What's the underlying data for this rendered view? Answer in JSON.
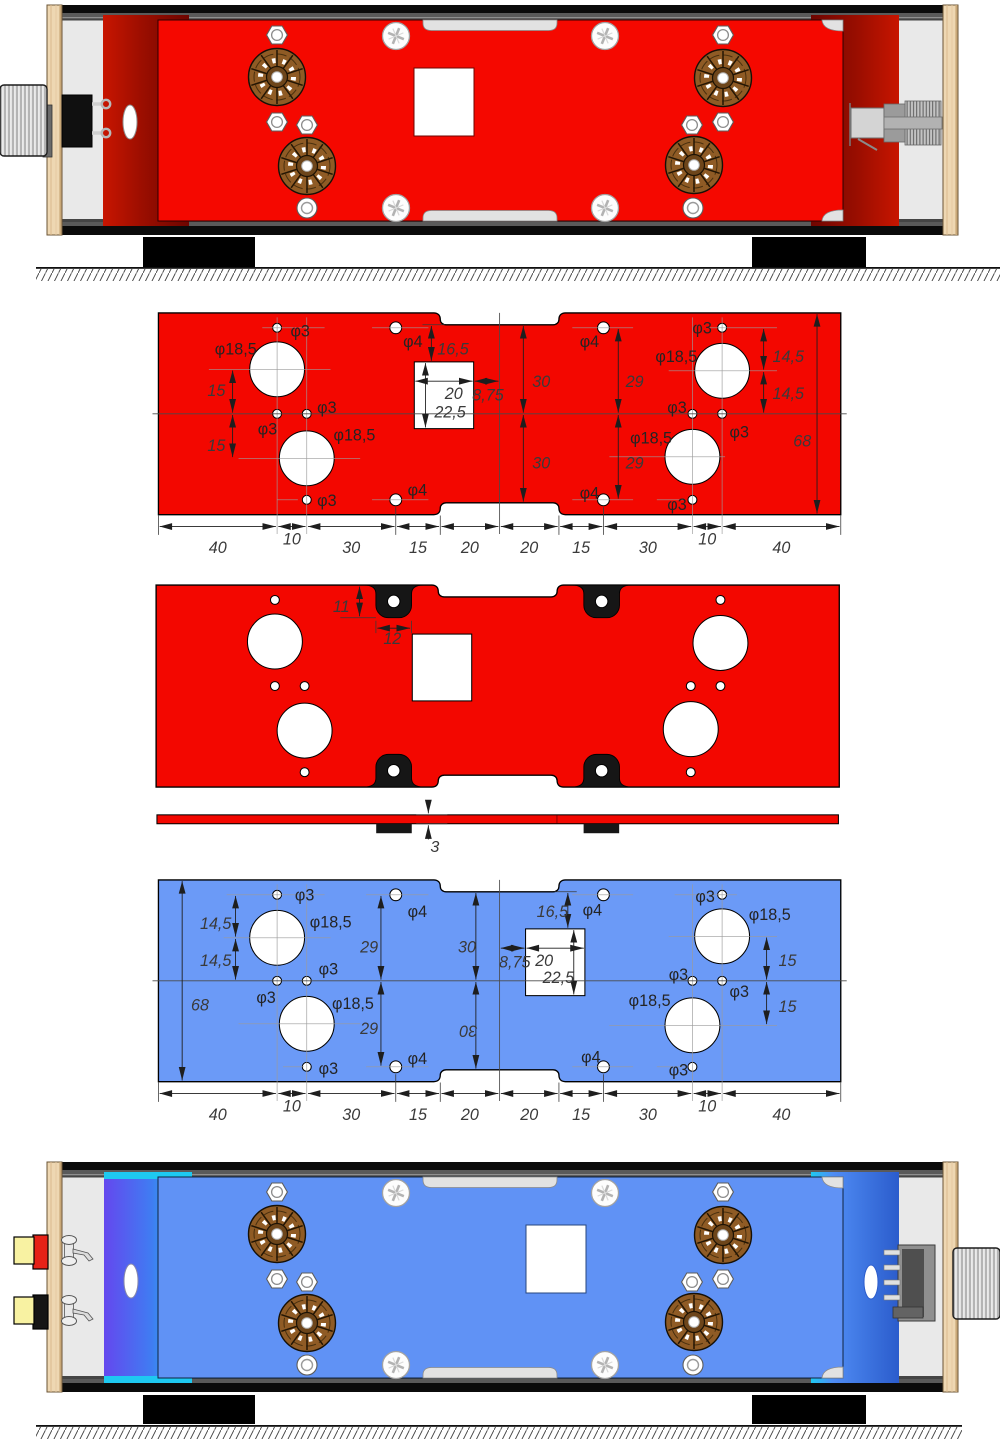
{
  "palette": {
    "red_plate": "#f30700",
    "blue_plate": "#6b9af7",
    "rendered_red_plate": "#f50800",
    "rendered_blue_plate": "#6092f5",
    "dark_red_panel": "#6e0500",
    "blue_panel_purple": "#6448ee",
    "cyan_edge": "#1ec9f1",
    "wood": "#eed7b2",
    "interior_gray": "#e9e9e9",
    "socket_brown": "#8f5b25",
    "rca_yellow": "#f8f2a2",
    "rca_red_ring": "#e62217",
    "dimension_text": "#3a3a3a"
  },
  "red_plate": {
    "labels": [
      {
        "t": "φ3",
        "x": 44.5,
        "y": 8
      },
      {
        "t": "φ18,5",
        "x": 19,
        "y": 14
      },
      {
        "t": "15",
        "x": 16.5,
        "y": 28,
        "it": 1
      },
      {
        "t": "15",
        "x": 16.5,
        "y": 46.5,
        "it": 1
      },
      {
        "t": "φ3",
        "x": 33.5,
        "y": 41
      },
      {
        "t": "φ3",
        "x": 53.5,
        "y": 33.8
      },
      {
        "t": "φ18,5",
        "x": 59,
        "y": 43
      },
      {
        "t": "φ3",
        "x": 53.5,
        "y": 65
      },
      {
        "t": "φ4",
        "x": 82.5,
        "y": 11.5
      },
      {
        "t": "φ4",
        "x": 84,
        "y": 61.5
      },
      {
        "t": "16,5",
        "x": 94,
        "y": 14,
        "it": 1
      },
      {
        "t": "20",
        "x": 96.5,
        "y": 29,
        "it": 1
      },
      {
        "t": "8,75",
        "x": 105.8,
        "y": 29.5,
        "it": 1
      },
      {
        "t": "22,5",
        "x": 93,
        "y": 35.3,
        "it": 1
      },
      {
        "t": "30",
        "x": 126,
        "y": 25,
        "it": 1
      },
      {
        "t": "30",
        "x": 126,
        "y": 52.5,
        "it": 1
      },
      {
        "t": "29",
        "x": 157.5,
        "y": 25,
        "it": 1
      },
      {
        "t": "29",
        "x": 157.5,
        "y": 52.5,
        "it": 1
      },
      {
        "t": "φ4",
        "x": 142,
        "y": 11.5
      },
      {
        "t": "φ4",
        "x": 142,
        "y": 62.5
      },
      {
        "t": "φ3",
        "x": 180,
        "y": 7
      },
      {
        "t": "φ18,5",
        "x": 167.5,
        "y": 16.5
      },
      {
        "t": "14,5",
        "x": 207,
        "y": 16.5,
        "it": 1
      },
      {
        "t": "14,5",
        "x": 207,
        "y": 29,
        "it": 1
      },
      {
        "t": "φ3",
        "x": 171.5,
        "y": 33.8
      },
      {
        "t": "φ3",
        "x": 192.5,
        "y": 42
      },
      {
        "t": "φ18,5",
        "x": 159,
        "y": 44
      },
      {
        "t": "68",
        "x": 214,
        "y": 45,
        "it": 1
      },
      {
        "t": "φ3",
        "x": 171.5,
        "y": 66.5
      },
      {
        "t": "40",
        "x": 20,
        "y": 81,
        "it": 1,
        "mid": 1
      },
      {
        "t": "10",
        "x": 45,
        "y": 78,
        "it": 1,
        "mid": 1
      },
      {
        "t": "30",
        "x": 65,
        "y": 81,
        "it": 1,
        "mid": 1
      },
      {
        "t": "15",
        "x": 87.5,
        "y": 81,
        "it": 1,
        "mid": 1
      },
      {
        "t": "20",
        "x": 105,
        "y": 81,
        "it": 1,
        "mid": 1
      },
      {
        "t": "20",
        "x": 125,
        "y": 81,
        "it": 1,
        "mid": 1
      },
      {
        "t": "15",
        "x": 142.5,
        "y": 81,
        "it": 1,
        "mid": 1
      },
      {
        "t": "30",
        "x": 165,
        "y": 81,
        "it": 1,
        "mid": 1
      },
      {
        "t": "10",
        "x": 185,
        "y": 78,
        "it": 1,
        "mid": 1
      },
      {
        "t": "40",
        "x": 210,
        "y": 81,
        "it": 1,
        "mid": 1
      }
    ]
  },
  "drill_plate": {
    "labels": [
      {
        "t": "11",
        "x": 59.5,
        "y": 9,
        "it": 1
      },
      {
        "t": "12",
        "x": 76.5,
        "y": 19.8,
        "it": 1
      }
    ]
  },
  "side_view": {
    "labels": [
      {
        "t": "3",
        "x": 92.3,
        "y": 12.6,
        "it": 1
      }
    ]
  },
  "blue_plate": {
    "labels": [
      {
        "t": "14,5",
        "x": 14,
        "y": 16.5,
        "it": 1
      },
      {
        "t": "14,5",
        "x": 14,
        "y": 29,
        "it": 1
      },
      {
        "t": "68",
        "x": 11,
        "y": 44,
        "it": 1
      },
      {
        "t": "φ3",
        "x": 46,
        "y": 7
      },
      {
        "t": "φ18,5",
        "x": 51,
        "y": 16
      },
      {
        "t": "φ3",
        "x": 54,
        "y": 31.8
      },
      {
        "t": "φ3",
        "x": 33,
        "y": 41.5
      },
      {
        "t": "φ18,5",
        "x": 58.5,
        "y": 43.5
      },
      {
        "t": "φ3",
        "x": 54,
        "y": 65.5
      },
      {
        "t": "29",
        "x": 68,
        "y": 24.5,
        "it": 1
      },
      {
        "t": "29",
        "x": 68,
        "y": 52,
        "it": 1
      },
      {
        "t": "φ4",
        "x": 84,
        "y": 12.5
      },
      {
        "t": "φ4",
        "x": 84,
        "y": 62
      },
      {
        "t": "30",
        "x": 101,
        "y": 24.5,
        "it": 1
      },
      {
        "t": "30",
        "x": 104.5,
        "y": 49,
        "it": 1,
        "mid": 1,
        "rot": 180
      },
      {
        "t": "16,5",
        "x": 127.5,
        "y": 12.5,
        "it": 1
      },
      {
        "t": "φ4",
        "x": 143,
        "y": 12
      },
      {
        "t": "φ4",
        "x": 142.5,
        "y": 61.5
      },
      {
        "t": "8,75",
        "x": 114.8,
        "y": 29.5,
        "it": 1
      },
      {
        "t": "20",
        "x": 127,
        "y": 29,
        "it": 1
      },
      {
        "t": "22,5",
        "x": 129.5,
        "y": 34.8,
        "it": 1
      },
      {
        "t": "φ3",
        "x": 172,
        "y": 33.8
      },
      {
        "t": "φ18,5",
        "x": 158.5,
        "y": 42.5
      },
      {
        "t": "φ3",
        "x": 181,
        "y": 7.5
      },
      {
        "t": "φ18,5",
        "x": 199,
        "y": 13.5
      },
      {
        "t": "φ3",
        "x": 192.5,
        "y": 39.5
      },
      {
        "t": "15",
        "x": 209,
        "y": 29,
        "it": 1
      },
      {
        "t": "15",
        "x": 209,
        "y": 44.5,
        "it": 1
      },
      {
        "t": "φ3",
        "x": 172,
        "y": 66
      },
      {
        "t": "40",
        "x": 20,
        "y": 81,
        "it": 1,
        "mid": 1
      },
      {
        "t": "10",
        "x": 45,
        "y": 78,
        "it": 1,
        "mid": 1
      },
      {
        "t": "30",
        "x": 65,
        "y": 81,
        "it": 1,
        "mid": 1
      },
      {
        "t": "15",
        "x": 87.5,
        "y": 81,
        "it": 1,
        "mid": 1
      },
      {
        "t": "20",
        "x": 105,
        "y": 81,
        "it": 1,
        "mid": 1
      },
      {
        "t": "20",
        "x": 125,
        "y": 81,
        "it": 1,
        "mid": 1
      },
      {
        "t": "15",
        "x": 142.5,
        "y": 81,
        "it": 1,
        "mid": 1
      },
      {
        "t": "30",
        "x": 165,
        "y": 81,
        "it": 1,
        "mid": 1
      },
      {
        "t": "10",
        "x": 185,
        "y": 78,
        "it": 1,
        "mid": 1
      },
      {
        "t": "40",
        "x": 210,
        "y": 81,
        "it": 1,
        "mid": 1
      }
    ]
  }
}
